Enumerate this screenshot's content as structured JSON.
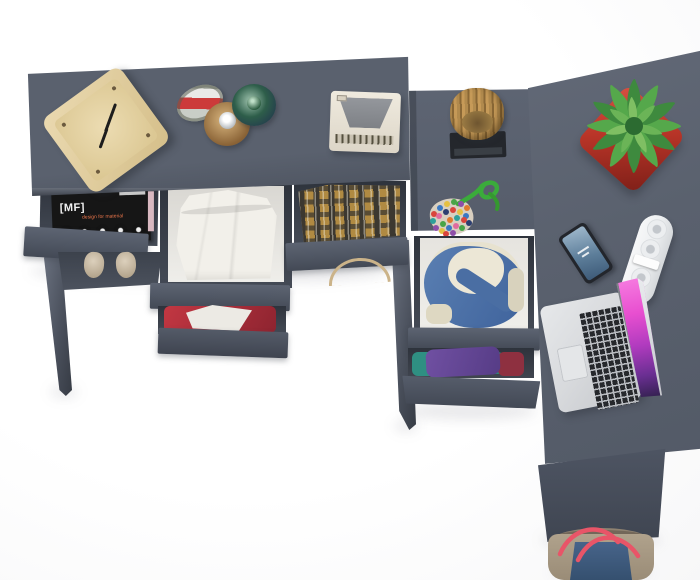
{
  "scene": {
    "type": "product-render",
    "description": "Overhead 3D render of a dark grey L-shaped home-office desk set with open drawers full of clothes and styled accessories on a white studio background",
    "background": "#fbfbfc"
  },
  "colors": {
    "desk": "#5a616e",
    "desk_deep": "#4b515d",
    "desk_front": "#4f5663",
    "desk_front_dark": "#434955",
    "inner_box": "#454b56",
    "floor_white": "#efeeea",
    "cloth_white": "#f2f0ea",
    "magazine_black": "#161616",
    "wood": "#ead9b0",
    "wood_dark": "#d5bf8a",
    "hanger_wood": "#cbb389",
    "tray_black": "#24272c",
    "plant_green": "#55a84b",
    "pot_red": "#b93528",
    "denim": "#5a7fb2",
    "denim_deep": "#3f639c",
    "lining": "#e7e2cf",
    "purple": "#7050a2",
    "teal": "#2f8f82",
    "maroon": "#8e3040",
    "red_cloth": "#c23742",
    "plaid_tan": "#b08a42",
    "plaid_dark": "#3c3830",
    "shoe_beige": "#dcd0bc",
    "strip_white": "#eceef0",
    "phone_body": "#23262c",
    "silver": "#d7d9dc",
    "key_black": "#26282c",
    "screen_pink": "#e84fd0",
    "screen_violet": "#6a2f92",
    "bag_taupe": "#b0a28c",
    "bag_navy": "#47648a",
    "strap_red": "#e85568",
    "rope_green": "#3bab3b"
  },
  "objects": {
    "left_desk": {
      "label": "grey console desk with three open drawers"
    },
    "clock": {
      "label": "wooden cube desk clock"
    },
    "perfume_bottles": {
      "label": "three perfume bottles"
    },
    "retro_radio": {
      "label": "cream retro radio"
    },
    "magazine": {
      "title": "[MF]",
      "subtitle": "design for material",
      "label": "black magazine in left drawer"
    },
    "white_pants": {
      "label": "folded white trousers in middle drawer"
    },
    "plaid_shirt": {
      "label": "brown plaid shirt in right drawer"
    },
    "shoes": {
      "label": "pair of beige shoes under desk"
    },
    "hanger": {
      "label": "wooden hanger"
    },
    "red_clothes": {
      "label": "red and white garments in lower drawer"
    },
    "storage_column": {
      "label": "drawer column joining the two desks"
    },
    "log_planter": {
      "label": "driftwood log on black tray"
    },
    "bead_pouch": {
      "label": "multicolour bead pouch with knotted green cord"
    },
    "denim_jacket": {
      "label": "denim jacket with cream lining in open drawer"
    },
    "folded_clothes": {
      "label": "purple, teal and maroon folded clothes"
    },
    "right_desk": {
      "label": "corner return desk"
    },
    "plant": {
      "label": "green succulent in red square pot"
    },
    "smartphone": {
      "label": "smartphone with blue wallpaper"
    },
    "power_strip": {
      "label": "white power strip with round sockets"
    },
    "laptop": {
      "label": "open silver laptop with magenta wallpaper"
    },
    "tote_bag": {
      "label": "canvas tote bag with navy panel and red straps"
    }
  }
}
